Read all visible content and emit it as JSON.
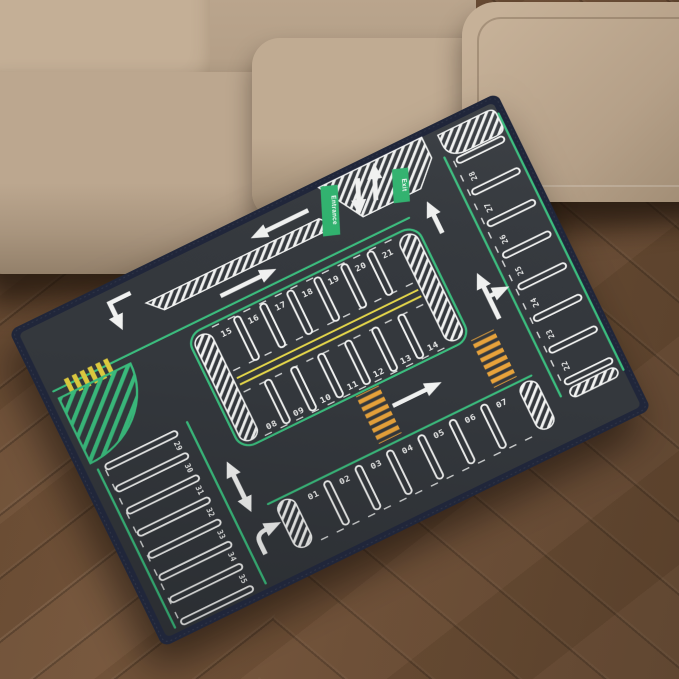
{
  "mat": {
    "signs": {
      "entrance": "Entrance",
      "exit": "Exit"
    },
    "spots": {
      "center_top_row": [
        "15",
        "16",
        "17",
        "18",
        "19",
        "20",
        "21"
      ],
      "center_bottom_row": [
        "08",
        "09",
        "10",
        "11",
        "12",
        "13",
        "14"
      ],
      "right_column": [
        "28",
        "27",
        "26",
        "25",
        "24",
        "23",
        "22"
      ],
      "left_column": [
        "29",
        "30",
        "31",
        "32",
        "33",
        "34",
        "35"
      ],
      "bottom_row": [
        "01",
        "02",
        "03",
        "04",
        "05",
        "06",
        "07"
      ]
    }
  },
  "palette": {
    "asphalt": "#34383d",
    "edge_navy": "#20263a",
    "marking_white": "#f2f3f2",
    "lane_green": "#3bbd7e",
    "center_yellow": "#e6d84a",
    "crosswalk_orange": "#e8a33b",
    "crosswalk_yellow": "#dfcb3f",
    "sign_green": "#2fb36e",
    "couch_beige": "#bda890",
    "floor_brown": "#6b4d34"
  }
}
